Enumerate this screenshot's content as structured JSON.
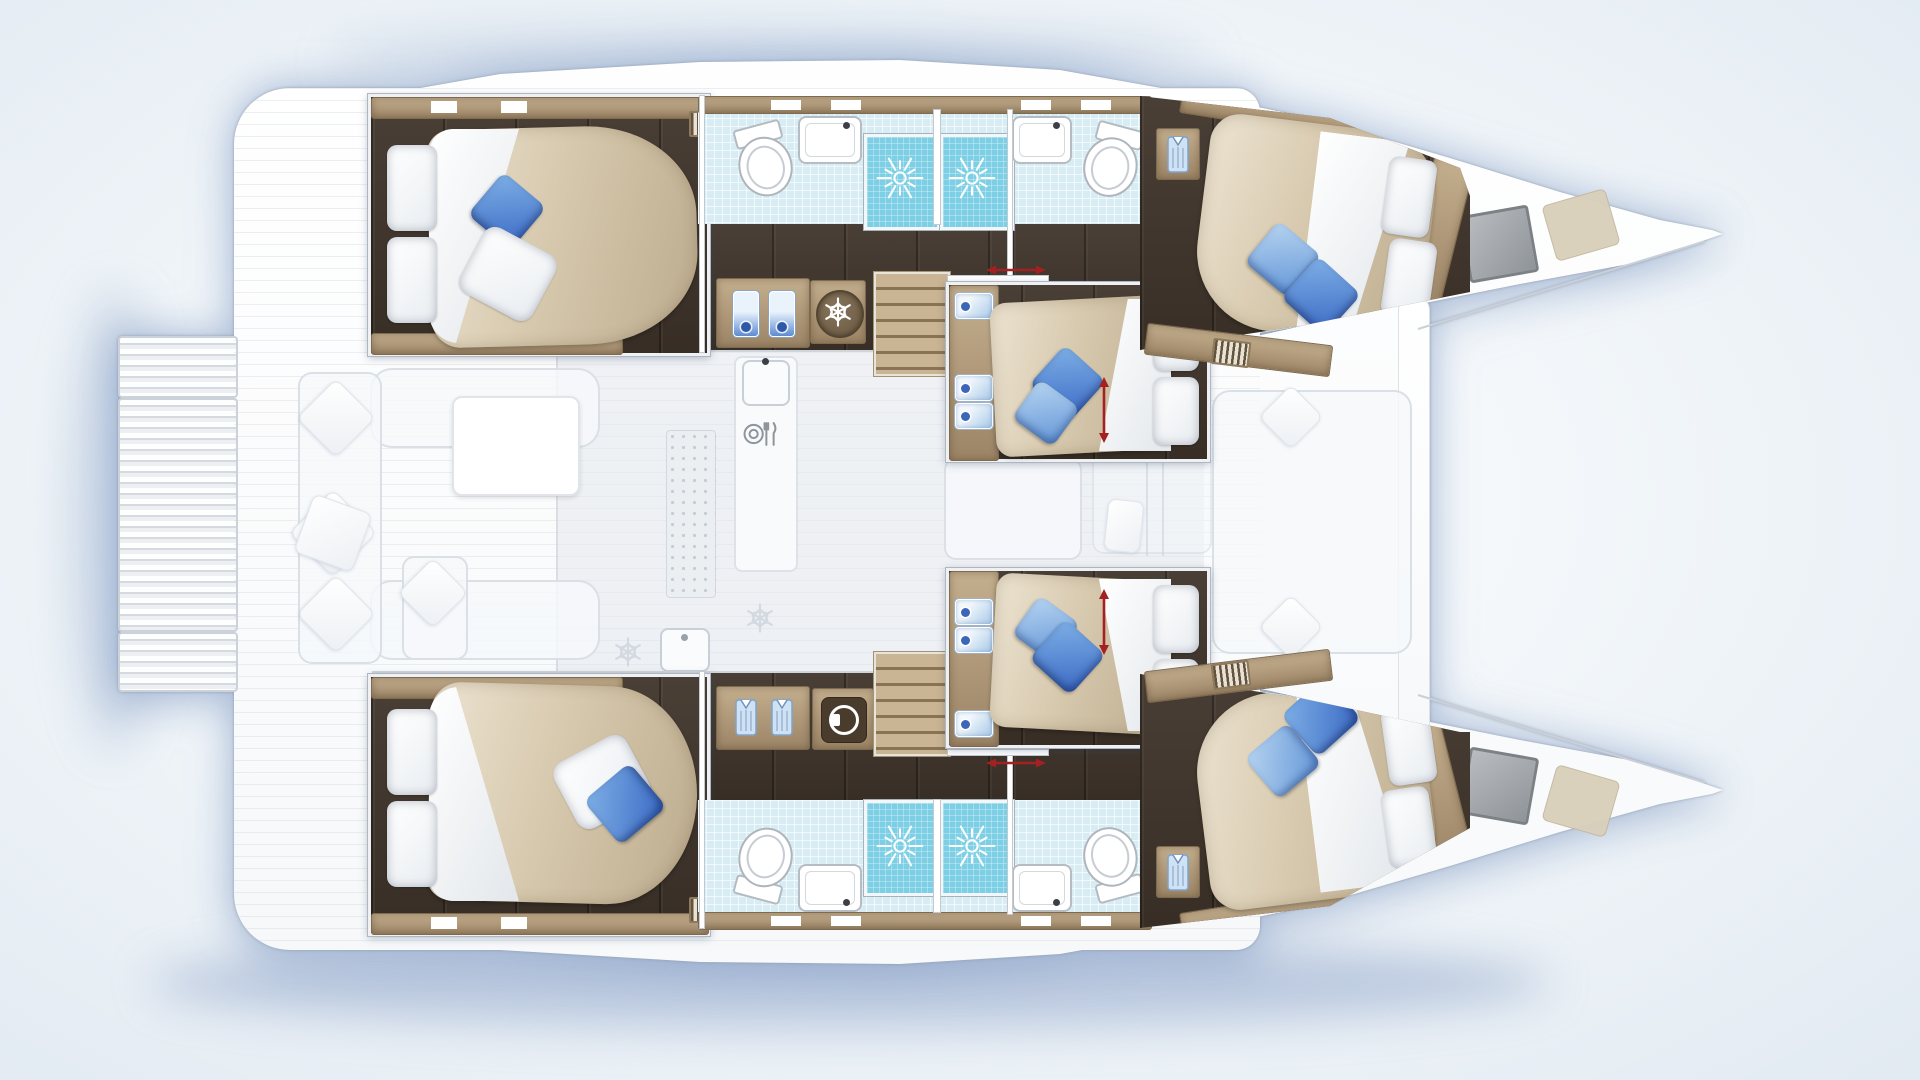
{
  "diagram": {
    "type": "catamaran-deck-plan",
    "orientation": "bow-right",
    "hull_count": 2,
    "cabin_count": 6,
    "bathroom_count": 4,
    "shower_count": 4,
    "bed_count": 6,
    "stairs_count": 2,
    "sliding_door_arrows": 2,
    "bed_extension_arrows": 2
  },
  "icons": {
    "shower": "sunburst-icon",
    "fridge": "snowflake-icon",
    "freezer_ghost": "snowflake-icon",
    "washer": "washing-machine-icon",
    "galley": "plate-fork-knife-icon",
    "wardrobe": "shirt-icon",
    "vent": "louvre-grille-icon",
    "door_slide": "double-arrow-horizontal-icon",
    "bed_extend": "double-arrow-vertical-icon"
  },
  "colors": {
    "floor_dark_wood": "#40352b",
    "trim_light_wood": "#b39e7f",
    "tile": "#d7edf3",
    "shower_glass": "#7ccfe4",
    "duvet_beige": "#d7c9ae",
    "pillow_blue_dark": "#3a69c4",
    "pillow_blue_light": "#6396d8",
    "arrow_red": "#a32121",
    "hull_white": "#ffffff",
    "shadow_blue": "#6c8ab9",
    "hatch_gray": "#9aa0a6"
  }
}
